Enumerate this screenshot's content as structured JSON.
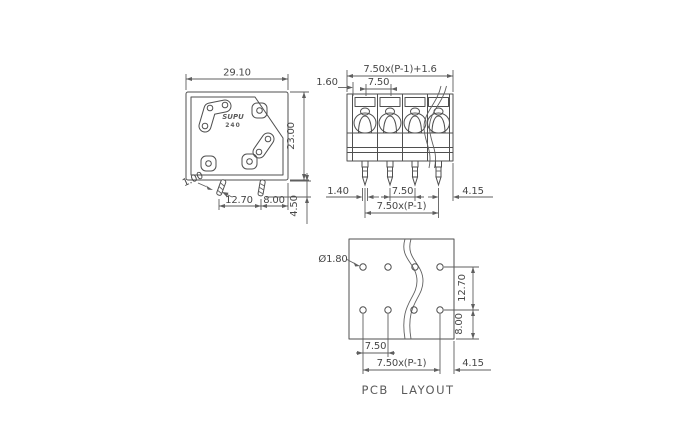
{
  "colors": {
    "line": "#4f4f4f",
    "text": "#474747",
    "background": "#ffffff"
  },
  "views": {
    "side": {
      "logo": {
        "brand": "SUPU",
        "model": "240"
      },
      "dims": {
        "body_width": "29.10",
        "body_height": "23.00",
        "pin_thickness": "1.00",
        "pin_spacing": "12.70",
        "pin_to_edge": "8.00",
        "pin_length": "4.50"
      }
    },
    "front": {
      "dims": {
        "total_width": "7.50x(P-1)+1.6",
        "pitch": "7.50",
        "end_margin": "1.60",
        "pin_width": "1.40",
        "pitch_bottom": "7.50",
        "pin_span": "7.50x(P-1)",
        "last_pin_to_edge": "4.15"
      }
    },
    "pcb": {
      "caption": "PCB LAYOUT",
      "dims": {
        "hole_diameter": "Ø1.80",
        "row_spacing": "12.70",
        "row_to_edge": "8.00",
        "pitch": "7.50",
        "hole_span": "7.50x(P-1)",
        "last_hole_to_edge": "4.15"
      }
    }
  }
}
